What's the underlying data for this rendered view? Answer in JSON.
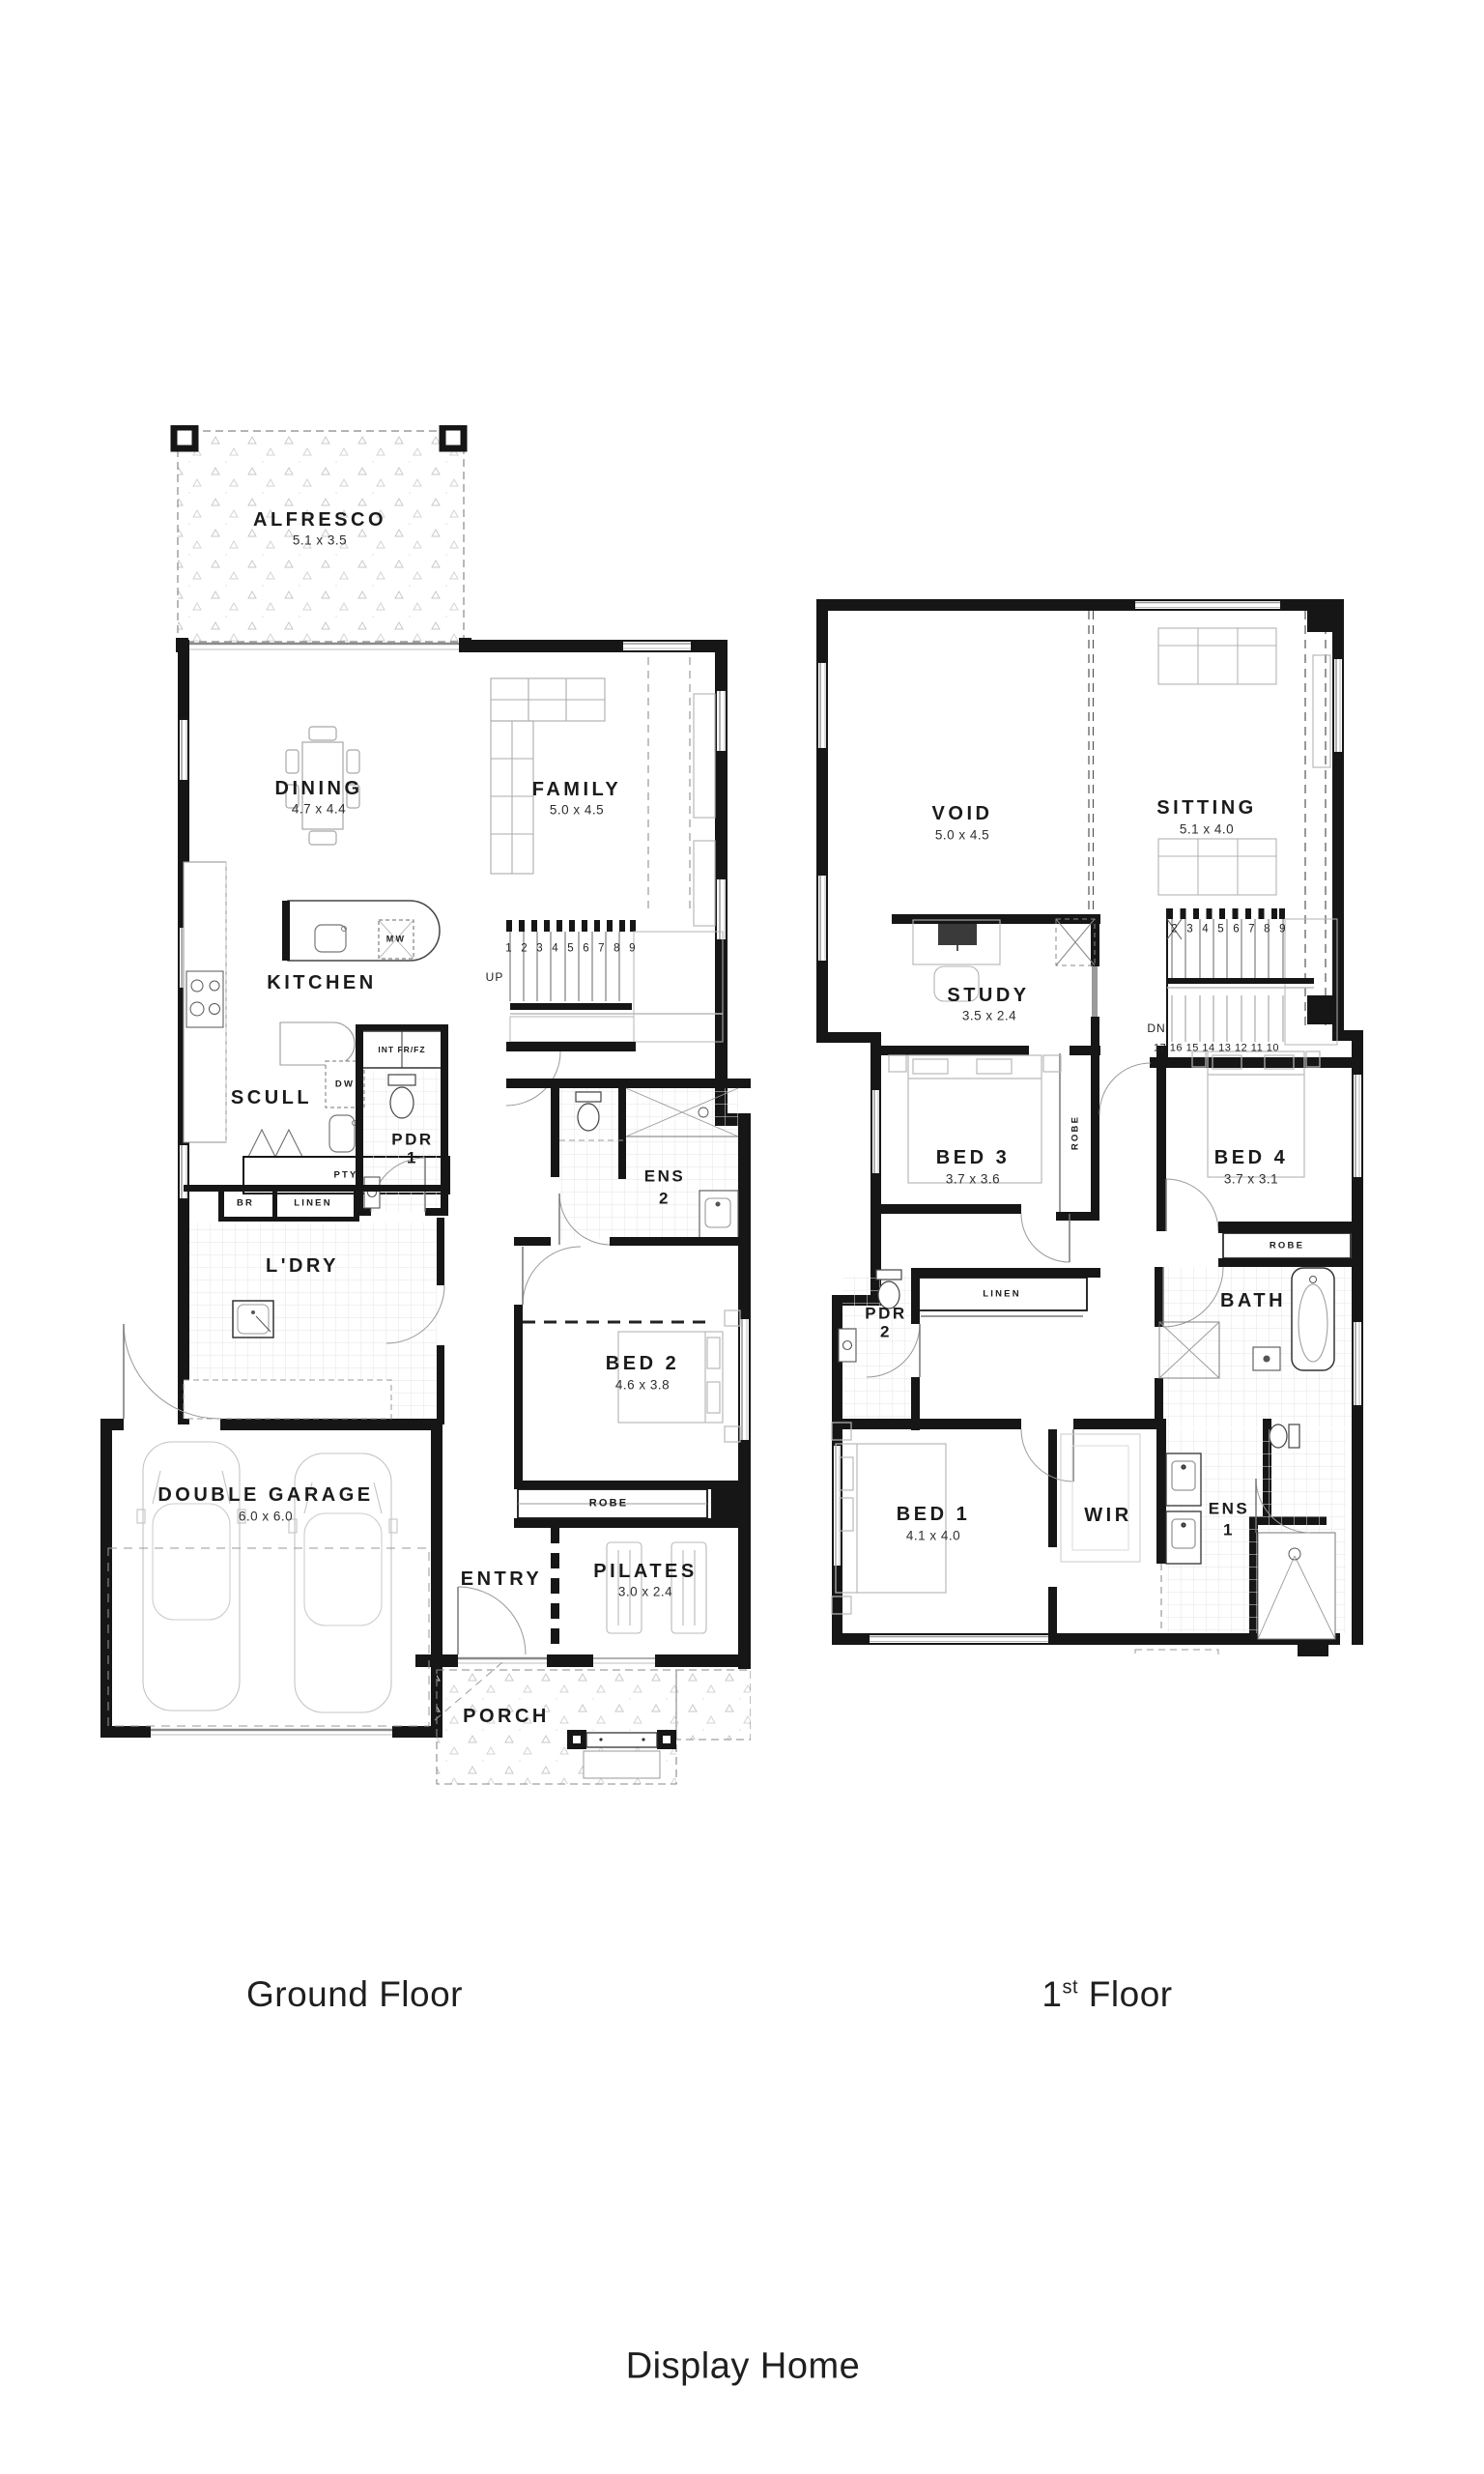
{
  "title": "Display Home",
  "ground": {
    "caption": "Ground Floor",
    "rooms": {
      "alfresco": {
        "name": "ALFRESCO",
        "dims": "5.1 x 3.5"
      },
      "dining": {
        "name": "DINING",
        "dims": "4.7 x 4.4"
      },
      "family": {
        "name": "FAMILY",
        "dims": "5.0 x 4.5"
      },
      "kitchen": {
        "name": "KITCHEN"
      },
      "scull": {
        "name": "SCULL"
      },
      "pdr1": {
        "name": "PDR",
        "num": "1"
      },
      "ens2": {
        "name": "ENS",
        "num": "2"
      },
      "ldry": {
        "name": "L'DRY"
      },
      "bed2": {
        "name": "BED 2",
        "dims": "4.6 x 3.8"
      },
      "garage": {
        "name": "DOUBLE GARAGE",
        "dims": "6.0 x 6.0"
      },
      "entry": {
        "name": "ENTRY"
      },
      "pilates": {
        "name": "PILATES",
        "dims": "3.0 x 2.4"
      },
      "porch": {
        "name": "PORCH"
      }
    },
    "small": {
      "mw": "MW",
      "up": "UP",
      "int_frfz": "INT FR/FZ",
      "dw": "DW",
      "pty": "PTY",
      "br": "BR",
      "linen": "LINEN",
      "robe": "ROBE",
      "stair_numbers": "1 2 3 4 5 6 7 8 9"
    }
  },
  "first": {
    "caption_num": "1",
    "caption_sup": "st",
    "caption_rest": " Floor",
    "rooms": {
      "void": {
        "name": "VOID",
        "dims": "5.0 x 4.5"
      },
      "sitting": {
        "name": "SITTING",
        "dims": "5.1 x 4.0"
      },
      "study": {
        "name": "STUDY",
        "dims": "3.5 x 2.4"
      },
      "bed3": {
        "name": "BED 3",
        "dims": "3.7 x 3.6"
      },
      "bed4": {
        "name": "BED 4",
        "dims": "3.7 x 3.1"
      },
      "bath": {
        "name": "BATH"
      },
      "pdr2": {
        "name": "PDR",
        "num": "2"
      },
      "bed1": {
        "name": "BED 1",
        "dims": "4.1 x 4.0"
      },
      "wir": {
        "name": "WIR"
      },
      "ens1": {
        "name": "ENS",
        "num": "1"
      }
    },
    "small": {
      "dn": "DN",
      "robe_vert": "ROBE",
      "robe_bed4": "ROBE",
      "linen": "LINEN",
      "stairs_up": "2 3 4 5 6 7 8 9",
      "stairs_down": "17 16 15 14 13 12 11 10"
    }
  }
}
